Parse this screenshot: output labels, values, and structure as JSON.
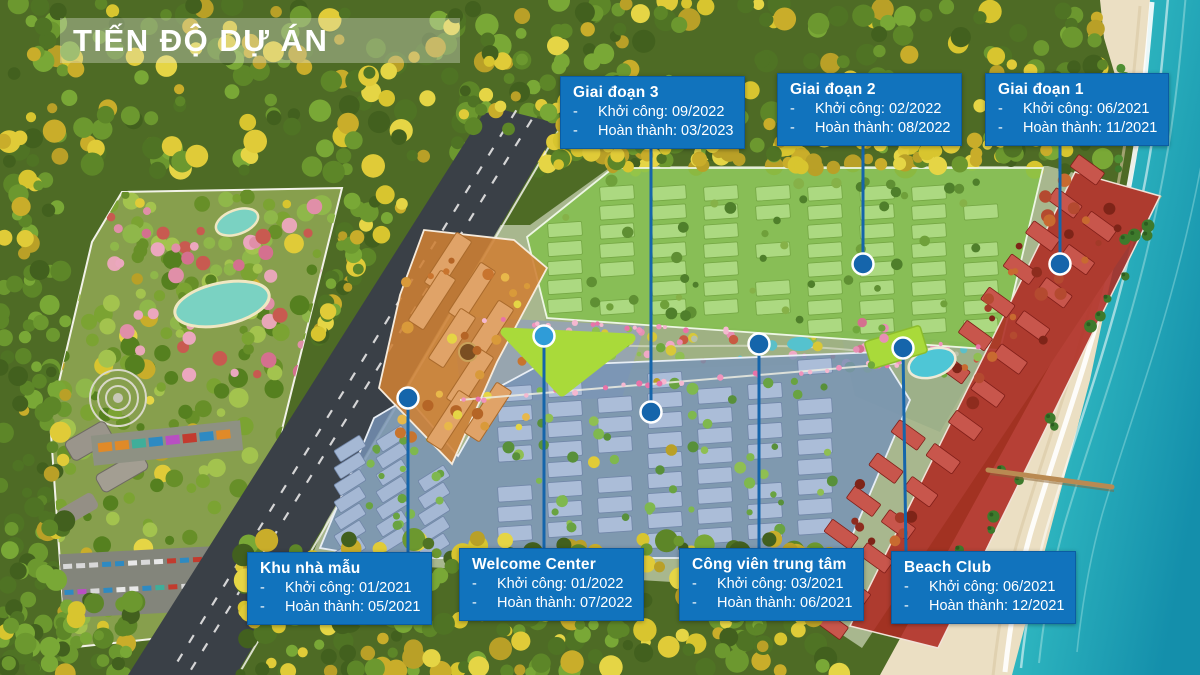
{
  "title": "TIẾN ĐỘ DỰ ÁN",
  "bullet": "-",
  "callouts": [
    {
      "id": "phase-3",
      "title": "Giai đoạn 3",
      "start": "Khởi công: 09/2022",
      "finish": "Hoàn thành: 03/2023"
    },
    {
      "id": "phase-2",
      "title": "Giai đoạn 2",
      "start": "Khởi công: 02/2022",
      "finish": "Hoàn thành: 08/2022"
    },
    {
      "id": "phase-1",
      "title": "Giai đoạn 1",
      "start": "Khởi công: 06/2021",
      "finish": "Hoàn thành: 11/2021"
    },
    {
      "id": "model-homes",
      "title": "Khu nhà mẫu",
      "start": "Khởi công: 01/2021",
      "finish": "Hoàn thành: 05/2021"
    },
    {
      "id": "welcome-center",
      "title": "Welcome Center",
      "start": "Khởi công: 01/2022",
      "finish": "Hoàn thành: 07/2022"
    },
    {
      "id": "central-park",
      "title": "Công viên trung tâm",
      "start": "Khởi công: 03/2021",
      "finish": "Hoàn thành: 06/2021"
    },
    {
      "id": "beach-club",
      "title": "Beach Club",
      "start": "Khởi công: 06/2021",
      "finish": "Hoàn thành: 12/2021"
    }
  ],
  "colors": {
    "callout_bg": "#1173BD",
    "callout_border": "#0B5CA2",
    "callout_text": "#FFFFFF",
    "title_text": "#FFFFFF",
    "title_band_bg": "rgba(226,230,220,0.36)",
    "leader": "#1565AB",
    "marker": "#1565AB",
    "marker_ring": "#FFFFFF",
    "marker_welcome": "#2F9CD8",
    "zone_phase1": "#AE2A22",
    "zone_phase2": "#7FBF48",
    "zone_phase3": "#7692B6",
    "zone_model": "#CE8034",
    "highlight_green": "#A9DA3A",
    "sea": "#2FB7C0",
    "sand": "#EBDFC3",
    "forest": "#4E6B25",
    "road": "#3A4047"
  }
}
